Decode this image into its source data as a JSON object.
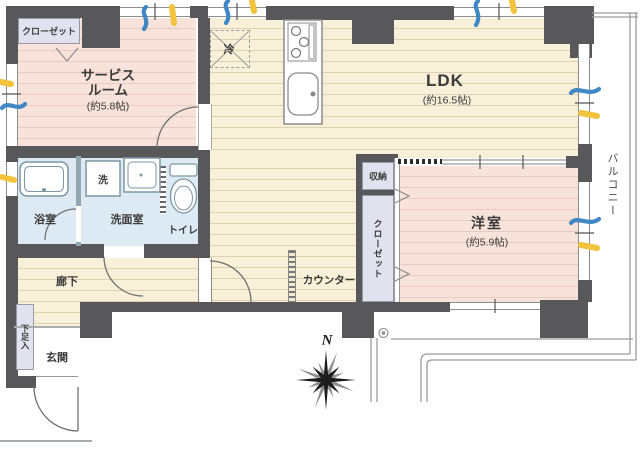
{
  "rooms": {
    "service_room": {
      "line1": "サービス",
      "line2": "ルーム",
      "size": "(約5.8帖)"
    },
    "ldk": {
      "name": "LDK",
      "size": "(約16.5帖)"
    },
    "western_room": {
      "name": "洋室",
      "size": "(約5.9帖)"
    },
    "balcony": {
      "name": "バルコニー"
    },
    "corridor": {
      "name": "廊下"
    },
    "entrance": {
      "name": "玄関"
    },
    "bathroom": {
      "name": "浴室"
    },
    "washroom": {
      "name": "洗面室"
    },
    "toilet": {
      "name": "トイレ"
    }
  },
  "fixtures": {
    "closet_top": "クローゼット",
    "closet_vertical": "クローゼット",
    "storage": "収納",
    "shoe_cabinet": "下足入",
    "counter": "カウンター",
    "refrigerator": "冷",
    "washing_machine": "洗"
  },
  "compass": {
    "north": "N"
  },
  "colors": {
    "wall": "#58585a",
    "wood_floor": "#f8f0d9",
    "pink_floor": "#f8e3da",
    "wet_area": "#ddeaf3",
    "closet": "#e2e2ef",
    "balcony_line": "#9a9a9a",
    "window_mark_blue": "#3f87c5",
    "window_mark_yellow": "#f2c43d"
  }
}
